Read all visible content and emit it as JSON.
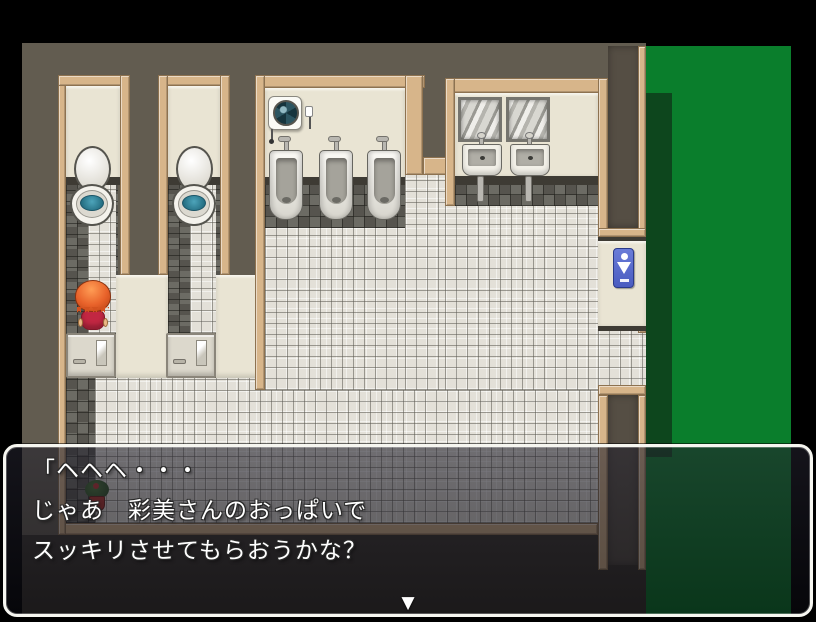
{
  "scene": {
    "type": "rpg-restroom-map",
    "viewport": {
      "width": 816,
      "height": 622
    }
  },
  "colors": {
    "letterbox_black": "#000000",
    "wall_taupe": "#625c50",
    "wood_tan": "#d7b58a",
    "wall_cream": "#e9e4d3",
    "floor_light_tile": "#e3e0d8",
    "floor_dark_tile": "#56544e",
    "outside_green": "#0a7e2c",
    "outside_green_shadow": "#0d461d",
    "sign_blue": "#5a6ed0",
    "toilet_water_teal": "#2f7f96",
    "npc_hair_orange": "#e8622a",
    "npc_dress_red": "#c22742"
  },
  "map": {
    "rooms": [
      "toilet-stall-1",
      "toilet-stall-2",
      "urinal-room",
      "sink-alcove",
      "entrance-corridor-top",
      "entrance-corridor-bottom"
    ],
    "objects": [
      "toilet",
      "toilet",
      "stall-door",
      "stall-door",
      "urinal",
      "urinal",
      "urinal",
      "ventilation-fan",
      "mirror",
      "mirror",
      "sink",
      "sink",
      "restroom-sign",
      "potted-plant",
      "npc-character"
    ]
  },
  "message_window": {
    "lines": [
      "「ヘヘヘ・・・",
      "じゃあ　彩美さんのおっぱいで",
      "スッキリさせてもらおうかな？"
    ],
    "continue_indicator": "▼"
  }
}
